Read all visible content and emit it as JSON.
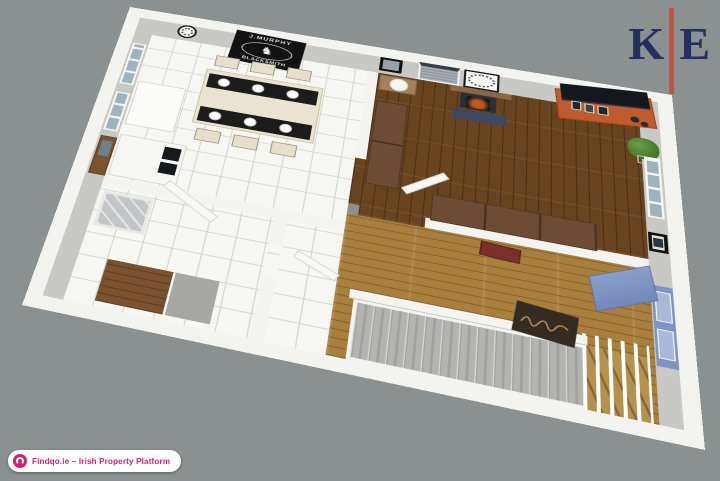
{
  "branding": {
    "logo": {
      "letter_left": "K",
      "letter_right": "E"
    },
    "badge": {
      "label": "Findqo.ie – Irish Property Platform"
    }
  },
  "floorplan": {
    "wall_sign": {
      "line1": "J.MURPHY",
      "line2": "BLACKSMITH"
    },
    "horse_icon": "♞"
  },
  "colors": {
    "background": "#8b9191",
    "logo_navy": "#232f5f",
    "logo_red": "#c8503e",
    "badge_pink": "#d81b74",
    "dark_floor": "#68431f",
    "hall_floor": "#a97f3e",
    "media_unit_orange": "#bf5b2e",
    "entrance_door_blue": "#7e93c6"
  }
}
